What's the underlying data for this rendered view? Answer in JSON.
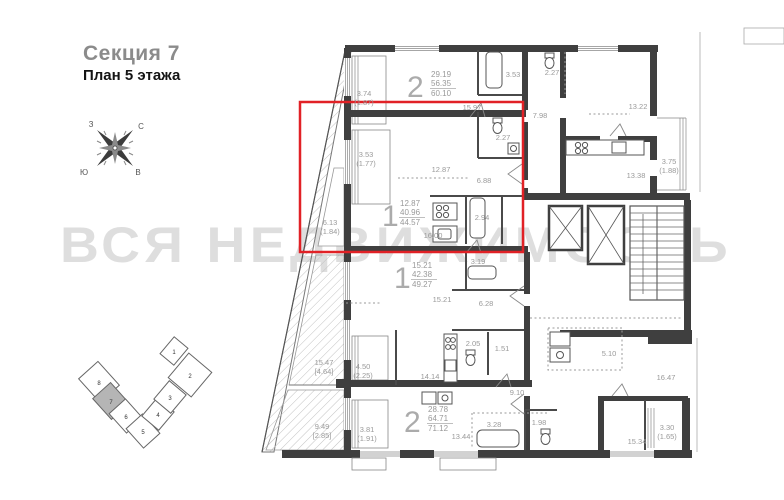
{
  "header": {
    "section": "Секция 7",
    "floor": "План 5 этажа"
  },
  "watermark": "ВСЯ НЕДВИЖИМОСТЬ",
  "compass": {
    "n": "С",
    "e": "В",
    "s": "Ю",
    "w": "З"
  },
  "accent_color": "#e12126",
  "apartments": [
    {
      "type": "2",
      "living": "29.19",
      "area": "56.35",
      "total": "60.10"
    },
    {
      "type": "1",
      "living": "12.87",
      "area": "40.96",
      "total": "44.57",
      "highlighted": true
    },
    {
      "type": "1",
      "living": "15.21",
      "area": "42.38",
      "total": "49.27"
    },
    {
      "type": "2",
      "living": "28.78",
      "area": "64.71",
      "total": "71.12"
    }
  ],
  "rooms": [
    {
      "a": "3.74",
      "b": "(1.87)"
    },
    {
      "a": "15.97"
    },
    {
      "a": "3.53"
    },
    {
      "a": "2.27"
    },
    {
      "a": "7.98"
    },
    {
      "a": "13.22"
    },
    {
      "a": "3.75",
      "b": "(1.88)"
    },
    {
      "a": "13.38"
    },
    {
      "a": "3.53",
      "b": "(1.77)"
    },
    {
      "a": "12.87"
    },
    {
      "a": "2.27"
    },
    {
      "a": "6.88"
    },
    {
      "a": "2.94"
    },
    {
      "a": "16.00"
    },
    {
      "a": "6.13",
      "b": "(1.84)"
    },
    {
      "a": "3.19"
    },
    {
      "a": "15.21"
    },
    {
      "a": "6.28"
    },
    {
      "a": "2.05"
    },
    {
      "a": "1.51"
    },
    {
      "a": "14.14"
    },
    {
      "a": "4.50",
      "b": "(2.25)"
    },
    {
      "a": "15.47",
      "b": "[4.64]"
    },
    {
      "a": "9.49",
      "b": "[2.85]"
    },
    {
      "a": "3.81",
      "b": "(1.91)"
    },
    {
      "a": "9.10"
    },
    {
      "a": "3.28"
    },
    {
      "a": "1.98"
    },
    {
      "a": "13.44"
    },
    {
      "a": "5.10"
    },
    {
      "a": "16.47"
    },
    {
      "a": "15.34"
    },
    {
      "a": "3.30",
      "b": "(1.65)"
    }
  ],
  "site_plan": {
    "sections": [
      "1",
      "2",
      "3",
      "4",
      "5",
      "6",
      "7",
      "8"
    ],
    "highlighted": "7"
  }
}
